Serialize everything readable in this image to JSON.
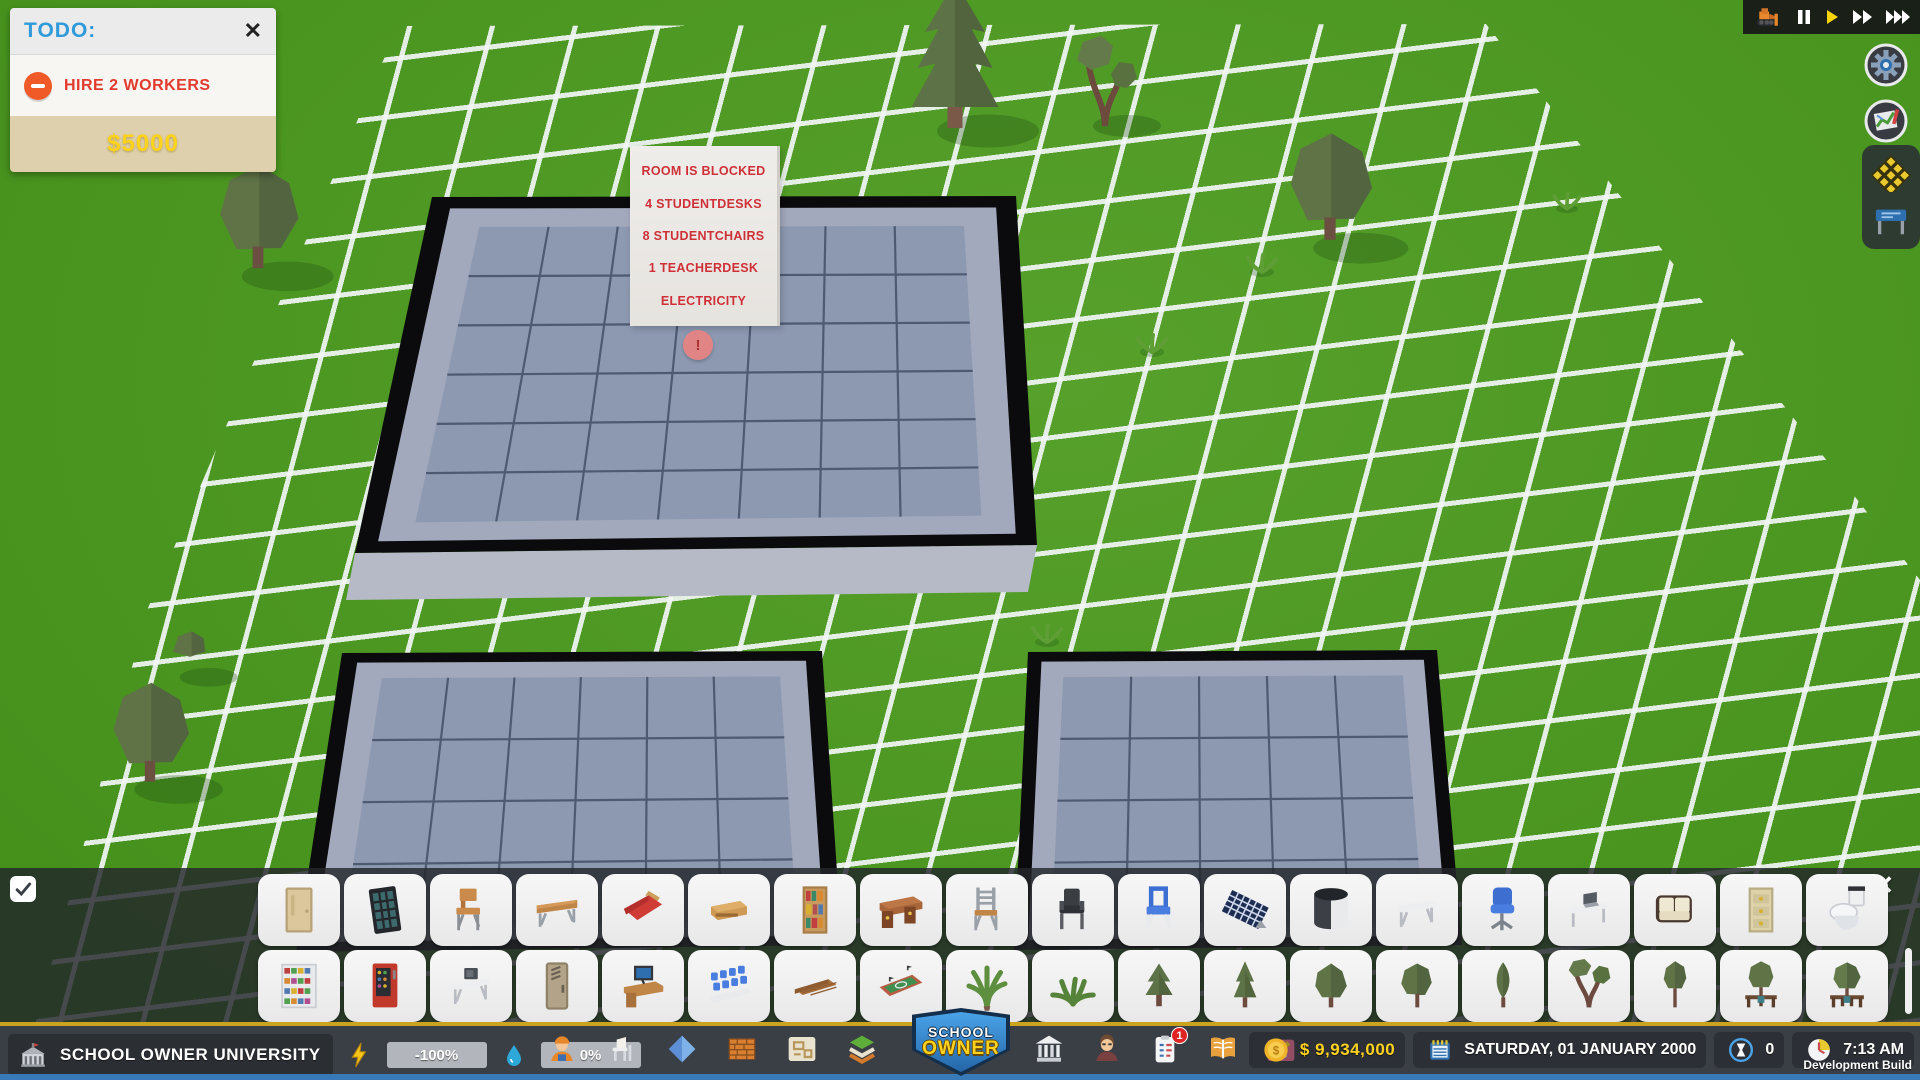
{
  "scene": {
    "tooltip": {
      "lines": [
        "ROOM IS BLOCKED",
        "4 STUDENTDESKS",
        "8 STUDENTCHAIRS",
        "1 TEACHERDESK",
        "ELECTRICITY"
      ]
    },
    "marker": "!",
    "rooms": [
      "classroom-large",
      "classroom-left",
      "classroom-right"
    ]
  },
  "todo_panel": {
    "title": "TODO:",
    "close_label": "✕",
    "task": {
      "icon": "minus-badge",
      "label": "HIRE 2 WORKERS"
    },
    "reward": "$5000"
  },
  "speed_controls": {
    "buttons": [
      "bulldozer",
      "pause",
      "play",
      "fast-forward",
      "fastest"
    ]
  },
  "side_buttons": {
    "buttons": [
      "settings-gear",
      "map"
    ]
  },
  "tool_panel": {
    "tools": [
      "move-tool",
      "furniture-tool"
    ]
  },
  "palette": {
    "checkbox_checked": true,
    "close_label": "✕",
    "rows": [
      [
        "door",
        "window",
        "school-chair",
        "long-table",
        "bed",
        "sideboard",
        "bookshelf",
        "teacher-desk",
        "ladder-chair",
        "dark-chair",
        "blue-chair",
        "solar-panel",
        "water-tank",
        "white-table",
        "office-chair",
        "computer-table",
        "sofa",
        "drawer-cabinet",
        "toilet"
      ],
      [
        "shop-shelf",
        "vending-machine",
        "microwave-table",
        "locker",
        "computer-desk",
        "lecture-seats",
        "wood-floor",
        "basketball-court",
        "palm-plant",
        "fern-plant",
        "pine-tree",
        "tall-pine-tree",
        "bushy-tree",
        "round-tree",
        "cypress-tree",
        "branchy-tree",
        "thin-tree",
        "bench-tree",
        "bench-tree-2"
      ]
    ]
  },
  "bottom_bar": {
    "school_name": "SCHOOL OWNER UNIVERSITY",
    "energy": {
      "icon": "lightning",
      "value": "-100%"
    },
    "water": {
      "icon": "water-drop",
      "value": "0%"
    },
    "build_icons": [
      "worker",
      "desk",
      "tiles",
      "bricks",
      "blueprint",
      "terrain-layers"
    ],
    "logo": {
      "line1": "SCHOOL",
      "line2": "OWNER"
    },
    "manage_icons": [
      "university",
      "staff",
      "tasks",
      "lessons",
      "research"
    ],
    "tasks_badge": "1",
    "money": "$ 9,934,000",
    "date": "SATURDAY, 01 JANUARY 2000",
    "hourglass_count": "0",
    "time": "7:13 AM",
    "build_label": "Development Build"
  },
  "colors": {
    "grass": "#4c9b1e",
    "grid_line": "#f0f3f2",
    "floor": "#8d99b1",
    "wall": "#0b0b0d",
    "accent_yellow": "#ffd21e",
    "accent_red": "#d93a35",
    "accent_blue": "#2f9bdb",
    "todo_orange": "#f05a28"
  }
}
